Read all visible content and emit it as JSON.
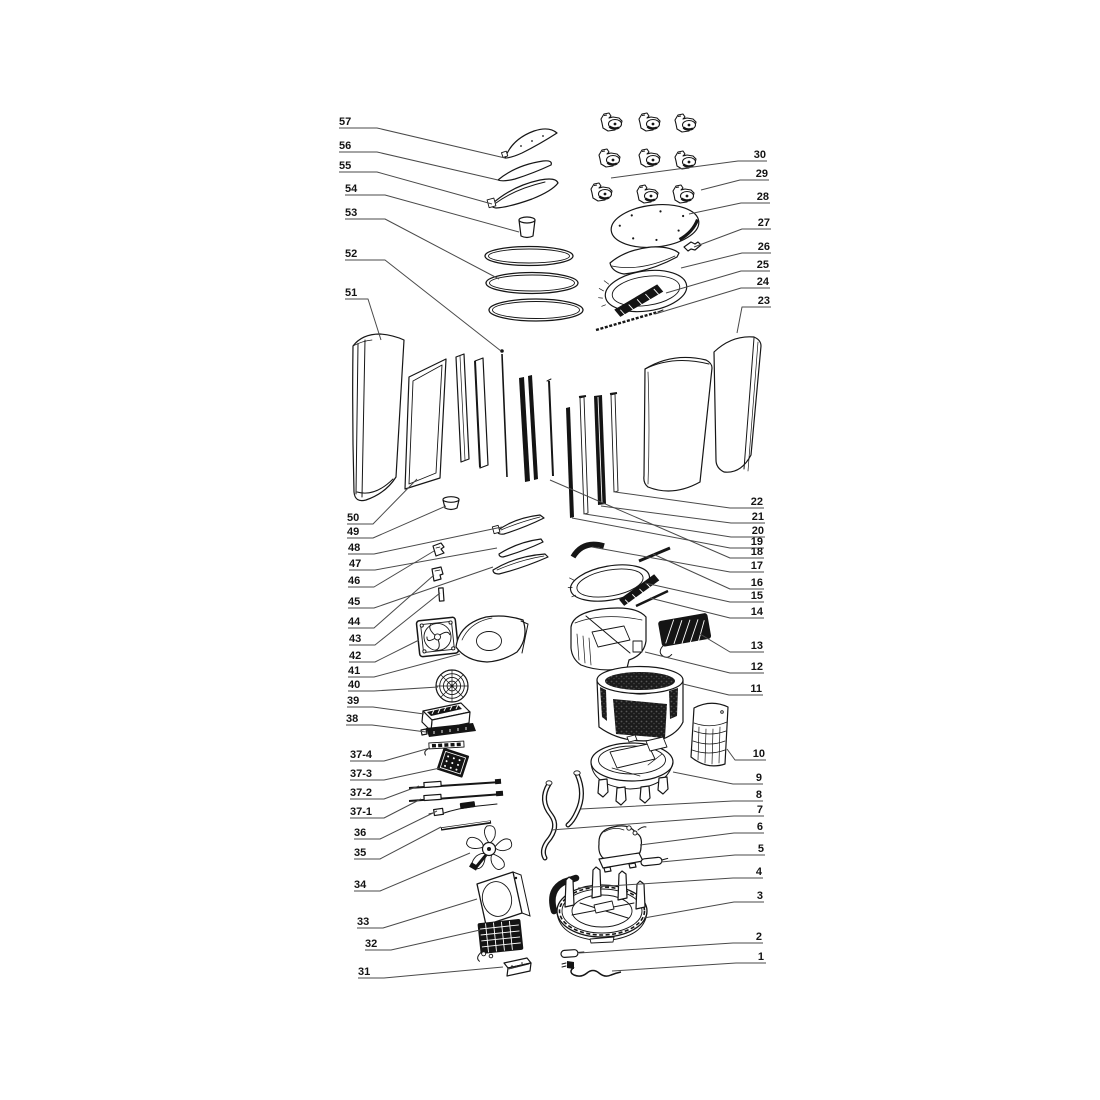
{
  "canvas": {
    "width": 1100,
    "height": 1100,
    "background": "#ffffff",
    "ink": "#161616",
    "leader_color": "#4a4a4a",
    "dark_fill": "#141414",
    "label_font_size": 11
  },
  "callouts": [
    {
      "label": "57",
      "tx": 339,
      "ty": 125,
      "anchor": "start",
      "leader": [
        [
          339,
          128
        ],
        [
          377,
          128
        ],
        [
          505,
          158
        ]
      ]
    },
    {
      "label": "56",
      "tx": 339,
      "ty": 149,
      "anchor": "start",
      "leader": [
        [
          339,
          152
        ],
        [
          377,
          152
        ],
        [
          498,
          180
        ]
      ]
    },
    {
      "label": "55",
      "tx": 339,
      "ty": 169,
      "anchor": "start",
      "leader": [
        [
          339,
          172
        ],
        [
          377,
          172
        ],
        [
          492,
          204
        ]
      ]
    },
    {
      "label": "54",
      "tx": 345,
      "ty": 192,
      "anchor": "start",
      "leader": [
        [
          345,
          195
        ],
        [
          385,
          195
        ],
        [
          519,
          232
        ]
      ]
    },
    {
      "label": "53",
      "tx": 345,
      "ty": 216,
      "anchor": "start",
      "leader": [
        [
          345,
          219
        ],
        [
          385,
          219
        ],
        [
          499,
          279
        ]
      ]
    },
    {
      "label": "52",
      "tx": 345,
      "ty": 257,
      "anchor": "start",
      "leader": [
        [
          345,
          260
        ],
        [
          385,
          260
        ],
        [
          501,
          351
        ]
      ]
    },
    {
      "label": "51",
      "tx": 345,
      "ty": 296,
      "anchor": "start",
      "leader": [
        [
          345,
          299
        ],
        [
          368,
          299
        ],
        [
          381,
          340
        ]
      ]
    },
    {
      "label": "50",
      "tx": 347,
      "ty": 521,
      "anchor": "start",
      "leader": [
        [
          347,
          524
        ],
        [
          373,
          524
        ],
        [
          417,
          479
        ]
      ]
    },
    {
      "label": "49",
      "tx": 347,
      "ty": 535,
      "anchor": "start",
      "leader": [
        [
          347,
          538
        ],
        [
          373,
          538
        ],
        [
          446,
          506
        ]
      ]
    },
    {
      "label": "48",
      "tx": 348,
      "ty": 551,
      "anchor": "start",
      "leader": [
        [
          348,
          554
        ],
        [
          374,
          554
        ],
        [
          502,
          527
        ]
      ]
    },
    {
      "label": "47",
      "tx": 349,
      "ty": 567,
      "anchor": "start",
      "leader": [
        [
          349,
          570
        ],
        [
          375,
          570
        ],
        [
          497,
          548
        ]
      ]
    },
    {
      "label": "46",
      "tx": 348,
      "ty": 584,
      "anchor": "start",
      "leader": [
        [
          348,
          587
        ],
        [
          374,
          587
        ],
        [
          434,
          551
        ]
      ]
    },
    {
      "label": "45",
      "tx": 348,
      "ty": 605,
      "anchor": "start",
      "leader": [
        [
          348,
          608
        ],
        [
          374,
          608
        ],
        [
          493,
          567
        ]
      ]
    },
    {
      "label": "44",
      "tx": 348,
      "ty": 625,
      "anchor": "start",
      "leader": [
        [
          348,
          628
        ],
        [
          374,
          628
        ],
        [
          434,
          575
        ]
      ]
    },
    {
      "label": "43",
      "tx": 349,
      "ty": 642,
      "anchor": "start",
      "leader": [
        [
          349,
          645
        ],
        [
          375,
          645
        ],
        [
          440,
          593
        ]
      ]
    },
    {
      "label": "42",
      "tx": 349,
      "ty": 659,
      "anchor": "start",
      "leader": [
        [
          349,
          662
        ],
        [
          375,
          662
        ],
        [
          419,
          640
        ]
      ]
    },
    {
      "label": "41",
      "tx": 348,
      "ty": 674,
      "anchor": "start",
      "leader": [
        [
          348,
          677
        ],
        [
          374,
          677
        ],
        [
          460,
          654
        ]
      ]
    },
    {
      "label": "40",
      "tx": 348,
      "ty": 688,
      "anchor": "start",
      "leader": [
        [
          348,
          691
        ],
        [
          374,
          691
        ],
        [
          438,
          687
        ]
      ]
    },
    {
      "label": "39",
      "tx": 347,
      "ty": 704,
      "anchor": "start",
      "leader": [
        [
          347,
          707
        ],
        [
          373,
          707
        ],
        [
          424,
          714
        ]
      ]
    },
    {
      "label": "38",
      "tx": 346,
      "ty": 722,
      "anchor": "start",
      "leader": [
        [
          346,
          725
        ],
        [
          372,
          725
        ],
        [
          426,
          732
        ]
      ]
    },
    {
      "label": "37-4",
      "tx": 350,
      "ty": 758,
      "anchor": "start",
      "leader": [
        [
          350,
          761
        ],
        [
          384,
          761
        ],
        [
          430,
          748
        ]
      ]
    },
    {
      "label": "37-3",
      "tx": 350,
      "ty": 777,
      "anchor": "start",
      "leader": [
        [
          350,
          780
        ],
        [
          384,
          780
        ],
        [
          440,
          768
        ]
      ]
    },
    {
      "label": "37-2",
      "tx": 350,
      "ty": 796,
      "anchor": "start",
      "leader": [
        [
          350,
          799
        ],
        [
          384,
          799
        ],
        [
          419,
          786
        ]
      ]
    },
    {
      "label": "37-1",
      "tx": 350,
      "ty": 815,
      "anchor": "start",
      "leader": [
        [
          350,
          818
        ],
        [
          384,
          818
        ],
        [
          421,
          799
        ]
      ]
    },
    {
      "label": "36",
      "tx": 354,
      "ty": 836,
      "anchor": "start",
      "leader": [
        [
          354,
          839
        ],
        [
          380,
          839
        ],
        [
          437,
          811
        ]
      ]
    },
    {
      "label": "35",
      "tx": 354,
      "ty": 856,
      "anchor": "start",
      "leader": [
        [
          354,
          859
        ],
        [
          380,
          859
        ],
        [
          441,
          827
        ]
      ]
    },
    {
      "label": "34",
      "tx": 354,
      "ty": 888,
      "anchor": "start",
      "leader": [
        [
          354,
          891
        ],
        [
          380,
          891
        ],
        [
          470,
          853
        ]
      ]
    },
    {
      "label": "33",
      "tx": 357,
      "ty": 925,
      "anchor": "start",
      "leader": [
        [
          357,
          928
        ],
        [
          383,
          928
        ],
        [
          477,
          899
        ]
      ]
    },
    {
      "label": "32",
      "tx": 365,
      "ty": 947,
      "anchor": "start",
      "leader": [
        [
          365,
          950
        ],
        [
          391,
          950
        ],
        [
          480,
          930
        ]
      ]
    },
    {
      "label": "31",
      "tx": 358,
      "ty": 975,
      "anchor": "start",
      "leader": [
        [
          358,
          978
        ],
        [
          384,
          978
        ],
        [
          503,
          967
        ]
      ]
    },
    {
      "label": "30",
      "tx": 766,
      "ty": 158,
      "anchor": "end",
      "leader": [
        [
          611,
          178
        ],
        [
          738,
          161
        ],
        [
          767,
          161
        ]
      ]
    },
    {
      "label": "29",
      "tx": 768,
      "ty": 177,
      "anchor": "end",
      "leader": [
        [
          701,
          190
        ],
        [
          740,
          180
        ],
        [
          769,
          180
        ]
      ]
    },
    {
      "label": "28",
      "tx": 769,
      "ty": 200,
      "anchor": "end",
      "leader": [
        [
          689,
          214
        ],
        [
          741,
          203
        ],
        [
          770,
          203
        ]
      ]
    },
    {
      "label": "27",
      "tx": 770,
      "ty": 226,
      "anchor": "end",
      "leader": [
        [
          694,
          247
        ],
        [
          742,
          229
        ],
        [
          771,
          229
        ]
      ]
    },
    {
      "label": "26",
      "tx": 770,
      "ty": 250,
      "anchor": "end",
      "leader": [
        [
          681,
          268
        ],
        [
          742,
          253
        ],
        [
          771,
          253
        ]
      ]
    },
    {
      "label": "25",
      "tx": 769,
      "ty": 268,
      "anchor": "end",
      "leader": [
        [
          666,
          293
        ],
        [
          741,
          271
        ],
        [
          770,
          271
        ]
      ]
    },
    {
      "label": "24",
      "tx": 769,
      "ty": 285,
      "anchor": "end",
      "leader": [
        [
          655,
          314
        ],
        [
          741,
          288
        ],
        [
          770,
          288
        ]
      ]
    },
    {
      "label": "23",
      "tx": 770,
      "ty": 304,
      "anchor": "end",
      "leader": [
        [
          737,
          333
        ],
        [
          742,
          307
        ],
        [
          771,
          307
        ]
      ]
    },
    {
      "label": "22",
      "tx": 763,
      "ty": 505,
      "anchor": "end",
      "leader": [
        [
          615,
          492
        ],
        [
          730,
          508
        ],
        [
          764,
          508
        ]
      ]
    },
    {
      "label": "21",
      "tx": 764,
      "ty": 520,
      "anchor": "end",
      "leader": [
        [
          601,
          506
        ],
        [
          731,
          523
        ],
        [
          765,
          523
        ]
      ]
    },
    {
      "label": "20",
      "tx": 764,
      "ty": 534,
      "anchor": "end",
      "leader": [
        [
          585,
          514
        ],
        [
          731,
          537
        ],
        [
          765,
          537
        ]
      ]
    },
    {
      "label": "19",
      "tx": 763,
      "ty": 545,
      "anchor": "end",
      "leader": [
        [
          572,
          518
        ],
        [
          730,
          548
        ],
        [
          764,
          548
        ]
      ]
    },
    {
      "label": "18",
      "tx": 763,
      "ty": 555,
      "anchor": "end",
      "leader": [
        [
          550,
          480
        ],
        [
          730,
          558
        ],
        [
          764,
          558
        ]
      ]
    },
    {
      "label": "17",
      "tx": 763,
      "ty": 569,
      "anchor": "end",
      "leader": [
        [
          592,
          547
        ],
        [
          730,
          572
        ],
        [
          764,
          572
        ]
      ]
    },
    {
      "label": "16",
      "tx": 763,
      "ty": 586,
      "anchor": "end",
      "leader": [
        [
          653,
          554
        ],
        [
          730,
          589
        ],
        [
          764,
          589
        ]
      ]
    },
    {
      "label": "15",
      "tx": 763,
      "ty": 599,
      "anchor": "end",
      "leader": [
        [
          645,
          583
        ],
        [
          730,
          602
        ],
        [
          764,
          602
        ]
      ]
    },
    {
      "label": "14",
      "tx": 763,
      "ty": 615,
      "anchor": "end",
      "leader": [
        [
          650,
          598
        ],
        [
          730,
          618
        ],
        [
          764,
          618
        ]
      ]
    },
    {
      "label": "13",
      "tx": 763,
      "ty": 649,
      "anchor": "end",
      "leader": [
        [
          700,
          634
        ],
        [
          730,
          652
        ],
        [
          764,
          652
        ]
      ]
    },
    {
      "label": "12",
      "tx": 763,
      "ty": 670,
      "anchor": "end",
      "leader": [
        [
          645,
          652
        ],
        [
          730,
          673
        ],
        [
          764,
          673
        ]
      ]
    },
    {
      "label": "11",
      "tx": 762,
      "ty": 692,
      "anchor": "end",
      "leader": [
        [
          683,
          684
        ],
        [
          729,
          695
        ],
        [
          763,
          695
        ]
      ]
    },
    {
      "label": "10",
      "tx": 765,
      "ty": 757,
      "anchor": "end",
      "leader": [
        [
          727,
          749
        ],
        [
          735,
          760
        ],
        [
          766,
          760
        ]
      ]
    },
    {
      "label": "9",
      "tx": 762,
      "ty": 781,
      "anchor": "end",
      "leader": [
        [
          673,
          772
        ],
        [
          733,
          784
        ],
        [
          763,
          784
        ]
      ]
    },
    {
      "label": "8",
      "tx": 762,
      "ty": 798,
      "anchor": "end",
      "leader": [
        [
          581,
          809
        ],
        [
          733,
          801
        ],
        [
          763,
          801
        ]
      ]
    },
    {
      "label": "7",
      "tx": 763,
      "ty": 813,
      "anchor": "end",
      "leader": [
        [
          551,
          830
        ],
        [
          734,
          816
        ],
        [
          764,
          816
        ]
      ]
    },
    {
      "label": "6",
      "tx": 763,
      "ty": 830,
      "anchor": "end",
      "leader": [
        [
          640,
          845
        ],
        [
          734,
          833
        ],
        [
          764,
          833
        ]
      ]
    },
    {
      "label": "5",
      "tx": 764,
      "ty": 852,
      "anchor": "end",
      "leader": [
        [
          661,
          862
        ],
        [
          735,
          855
        ],
        [
          765,
          855
        ]
      ]
    },
    {
      "label": "4",
      "tx": 762,
      "ty": 875,
      "anchor": "end",
      "leader": [
        [
          578,
          888
        ],
        [
          733,
          878
        ],
        [
          763,
          878
        ]
      ]
    },
    {
      "label": "3",
      "tx": 763,
      "ty": 899,
      "anchor": "end",
      "leader": [
        [
          644,
          918
        ],
        [
          734,
          902
        ],
        [
          764,
          902
        ]
      ]
    },
    {
      "label": "2",
      "tx": 762,
      "ty": 940,
      "anchor": "end",
      "leader": [
        [
          579,
          953
        ],
        [
          733,
          943
        ],
        [
          763,
          943
        ]
      ]
    },
    {
      "label": "1",
      "tx": 764,
      "ty": 960,
      "anchor": "end",
      "leader": [
        [
          612,
          971
        ],
        [
          736,
          963
        ],
        [
          766,
          963
        ]
      ]
    }
  ]
}
